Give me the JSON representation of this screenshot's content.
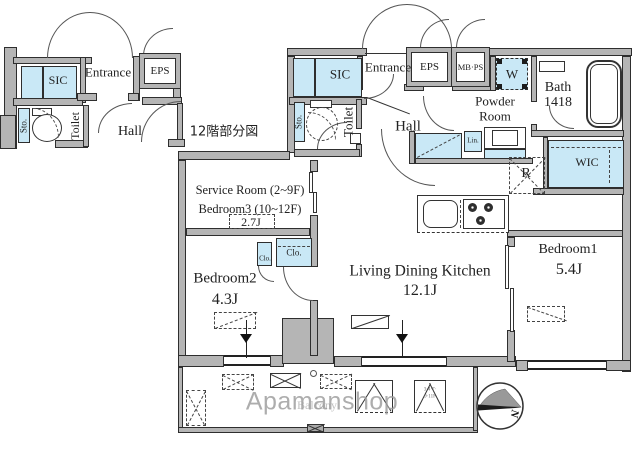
{
  "inset": {
    "caption": "12階部分図",
    "sic": "SIC",
    "entrance": "Entrance",
    "eps": "EPS",
    "sto": "Sto.",
    "toilet": "Toilet",
    "hall": "Hall"
  },
  "main": {
    "sic": "SIC",
    "entrance": "Entrance",
    "eps": "EPS",
    "mbps": "MB·PS",
    "washer": "W",
    "powder1": "Powder",
    "powder2": "Room",
    "bath": "Bath",
    "bath_size": "1418",
    "sto": "Sto.",
    "toilet": "Toilet",
    "hall": "Hall",
    "linen": "Lin.",
    "wic": "WIC",
    "fridge": "R",
    "service1": "Service Room (2~9F)",
    "service2": "Bedroom3 (10~12F)",
    "service_size": "2.7J",
    "closet_small": "Clo.",
    "closet_large": "Clo.",
    "bedroom2": "Bedroom2",
    "bedroom2_size": "4.3J",
    "ldk": "Living Dining Kitchen",
    "ldk_size": "12.1J",
    "bedroom1": "Bedroom1",
    "bedroom1_size": "5.4J"
  },
  "balcony": {
    "label": "Balcony",
    "ac_floors_1": "3·4·7·",
    "ac_floors_2": "9·11F"
  },
  "compass": {
    "north": "N"
  },
  "watermark": {
    "text": "Apamanshop"
  },
  "colors": {
    "fixture_blue": "#c9e8f6",
    "wall_gray": "#b5b5b5",
    "line": "#2e2e2e",
    "watermark_gray": "#9c9c9c"
  }
}
